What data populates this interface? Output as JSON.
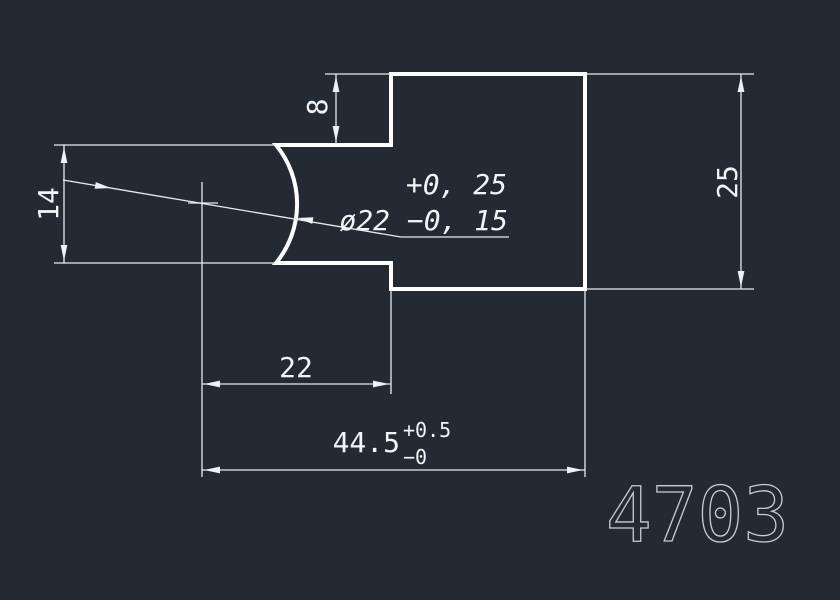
{
  "drawing": {
    "part_number": "4703",
    "colors": {
      "background": "#242a33",
      "geometry_line": "#ffffff",
      "dimension_line": "#e8ebee",
      "dimension_text": "#f2f4f6",
      "part_number_text": "#c6ccd3"
    },
    "dimensions": {
      "step_height": {
        "value": "8"
      },
      "slot_height": {
        "value": "14"
      },
      "overall_height": {
        "value": "25"
      },
      "step_length": {
        "value": "22"
      },
      "overall_length": {
        "value": "44.5",
        "tol_plus": "+0.5",
        "tol_minus": "−0"
      },
      "diameter_note": {
        "tol_plus": "+0, 25",
        "value": "ø22 −0, 15"
      }
    }
  }
}
